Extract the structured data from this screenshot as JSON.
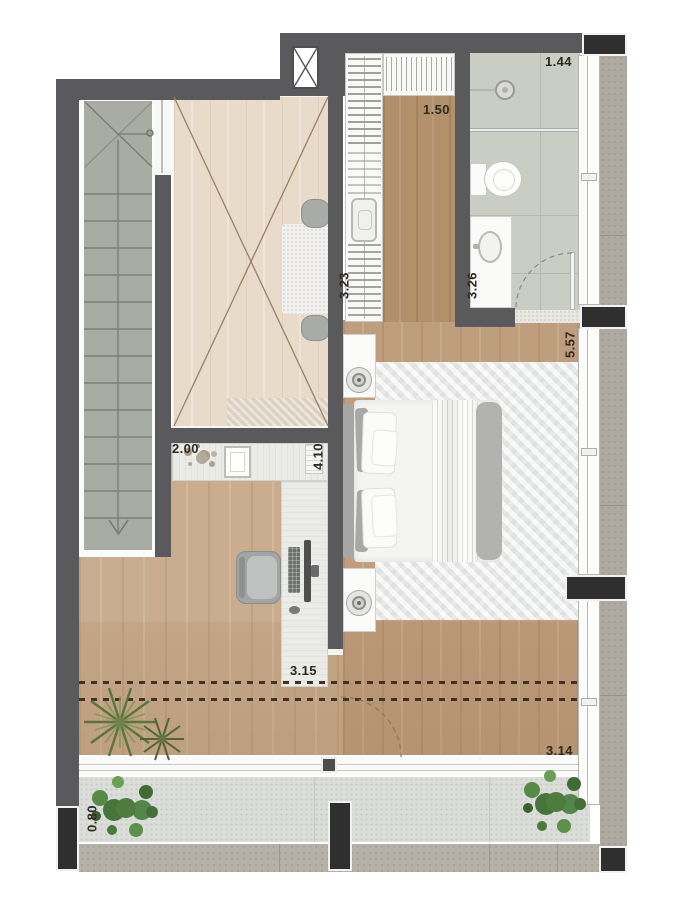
{
  "type": "floor-plan",
  "dimension_labels": {
    "bathroom_width_m": "1.44",
    "closet_depth_m": "1.50",
    "closet_length_m": "3.23",
    "bathroom_length_m": "3.26",
    "bedroom_length_m": "5.57",
    "desk_nook_width_m": "2.00",
    "desk_run_length_m": "4.10",
    "office_width_m": "3.15",
    "terrace_width_m": "3.14",
    "balcony_depth_m": "0.80"
  },
  "colors": {
    "wall": "#5a5a5c",
    "column": "#2f2f2f",
    "stair_tread": "#a9aca2",
    "wood_light": "#e8dbca",
    "wood_mid": "#c9ad8e",
    "wood_warm": "#bf9e7d",
    "wood_dark": "#b2906c",
    "bath_tile": "#cacdc3",
    "terrace_floor": "#dbddd9",
    "ledge": "#aeaaa2",
    "plant_green": "#4d7c3e",
    "rug": "#eef0ef"
  }
}
